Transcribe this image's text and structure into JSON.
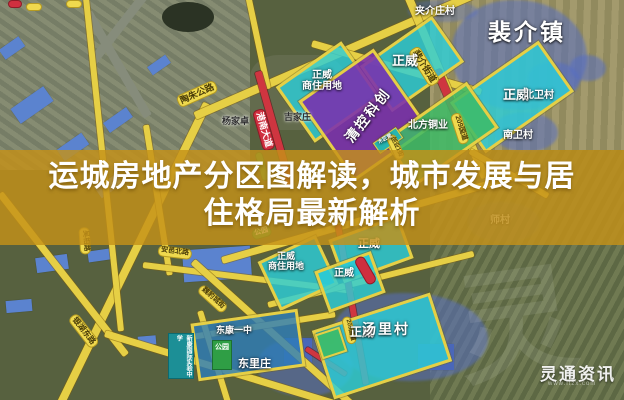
{
  "title": {
    "line1": "运城房地产分区图解读，城市发展与居",
    "line2": "住格局最新解析"
  },
  "watermark": {
    "brand": "灵通资讯",
    "url": "www.ltzx.com",
    "big_glyph": "灵"
  },
  "zones": {
    "zhengwei_top": "正威",
    "zhengwei_right": "正威",
    "zhengwei_biz_top_line1": "正威",
    "zhengwei_biz_top_line2": "商住用地",
    "qingkong": "清控科创",
    "beifang": "北方铜业",
    "mujiang": "木匠营",
    "zhengwei_biz_bottom_line1": "正威",
    "zhengwei_biz_bottom_line2": "商住用地",
    "zhengwei_b1": "正威",
    "zhengwei_b2": "正威",
    "zhengwei_b3": "正威"
  },
  "roads": {
    "taozhu": "陶朱公路",
    "peijie_street": "裴介街道",
    "g209": "209国道",
    "g209_b": "209国道",
    "gangnan": "港南大道",
    "yinhu": "银湖东路",
    "weibao": "魏豹城街",
    "anyi": "安邑北路",
    "chuangye": "创业1街",
    "wuxiang": "吴相路",
    "park_pill": "公园"
  },
  "places": {
    "peijie_town": "裴介镇",
    "jiajiezhuang": "夹介庄村",
    "beiwei": "北卫村",
    "nanwei": "南卫村",
    "shicun": "师村",
    "tangli": "汤里村",
    "donglizhuang": "东里庄",
    "yangjiazhuo": "杨家卓",
    "jijiazhuang": "吉家庄"
  },
  "pois": {
    "dongkang": "东康一中",
    "xinkang": "新康国际实验中学",
    "park": "公园"
  },
  "colors": {
    "band_gold": "#c4911a",
    "road_yellow": "#e6cf45",
    "zone_cyan": "#2ccdd7",
    "zone_purple": "#7b2fae",
    "zone_green": "#3dbb66",
    "village_blue": "#5570c3",
    "highway_red": "#cf3540"
  }
}
